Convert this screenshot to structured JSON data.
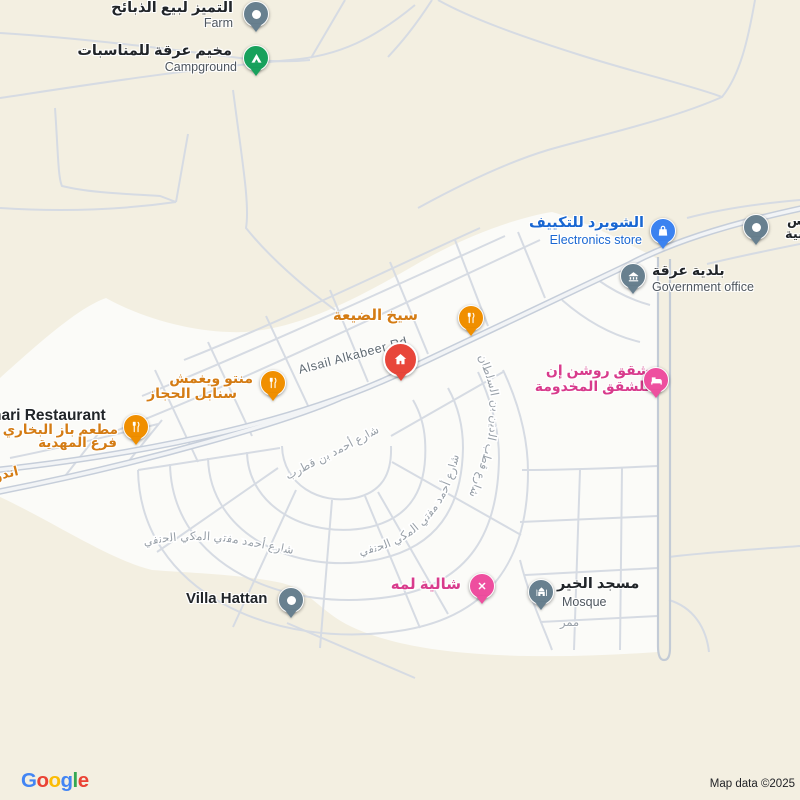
{
  "palette": {
    "bg": "#f3efe1",
    "urban": "#fbfbf8",
    "road_thin": "#d6dbe3",
    "road_casing": "#c6ceda",
    "road_fill": "#f2f4f6",
    "pin_slate": "#68808f",
    "pin_green": "#18a15c",
    "pin_blue": "#3b82f0",
    "pin_orange": "#f08f00",
    "pin_red": "#e8463a",
    "pin_pink": "#ee4f9f",
    "label_dark": "#212529",
    "label_gray": "#4e565e",
    "label_orange": "#d47c14",
    "label_blue": "#1967d2",
    "label_pink": "#d83b8c",
    "street_gray": "#98a0a8",
    "road_label_color": "#5f6a72",
    "attribution_color": "#1f2125"
  },
  "logo": {
    "text": "Google",
    "letters": [
      {
        "ch": "G",
        "color": "#4285F4"
      },
      {
        "ch": "o",
        "color": "#EA4335"
      },
      {
        "ch": "o",
        "color": "#FBBC05"
      },
      {
        "ch": "g",
        "color": "#4285F4"
      },
      {
        "ch": "l",
        "color": "#34A853"
      },
      {
        "ch": "e",
        "color": "#EA4335"
      }
    ]
  },
  "attribution": "Map data ©2025",
  "road_label": "Alsail Alkabeer Rd",
  "streets": {
    "qutrub": "شارع أحمد بن قطرب",
    "mufti": "شارع أحمد مفتي المكي الحنفي",
    "qutb": "شارع قطب الدين بن السلطان",
    "mamarr": "ممر",
    "ando": "اندو"
  },
  "pois": {
    "farm": {
      "ar": "التميز لبيع الذبائح",
      "en": "Farm"
    },
    "campground": {
      "ar": "مخيم عرقة للمناسبات",
      "en": "Campground"
    },
    "electronics": {
      "ar": "الشويرد للتكييف",
      "en": "Electronics store"
    },
    "clipped": {
      "line1": "دس",
      "line2": "سية"
    },
    "government": {
      "ar": "بلدية عرقة",
      "en": "Government office"
    },
    "seekh": {
      "ar": "سيخ الضيعة"
    },
    "manto": {
      "line1": "منتو ويغمش",
      "line2": "سنابل الحجاز"
    },
    "bukhari": {
      "en": "hari Restaurant",
      "ar1": "مطعم باز البخاري",
      "ar2": "فرع المهدية"
    },
    "roshan": {
      "line1": "شقق روشن إن",
      "line2": "للشقق المخدومة"
    },
    "chalet": {
      "ar": "شالية لمه"
    },
    "mosque": {
      "ar": "مسجد الخير",
      "en": "Mosque"
    },
    "villa": {
      "en": "Villa Hattan"
    }
  }
}
